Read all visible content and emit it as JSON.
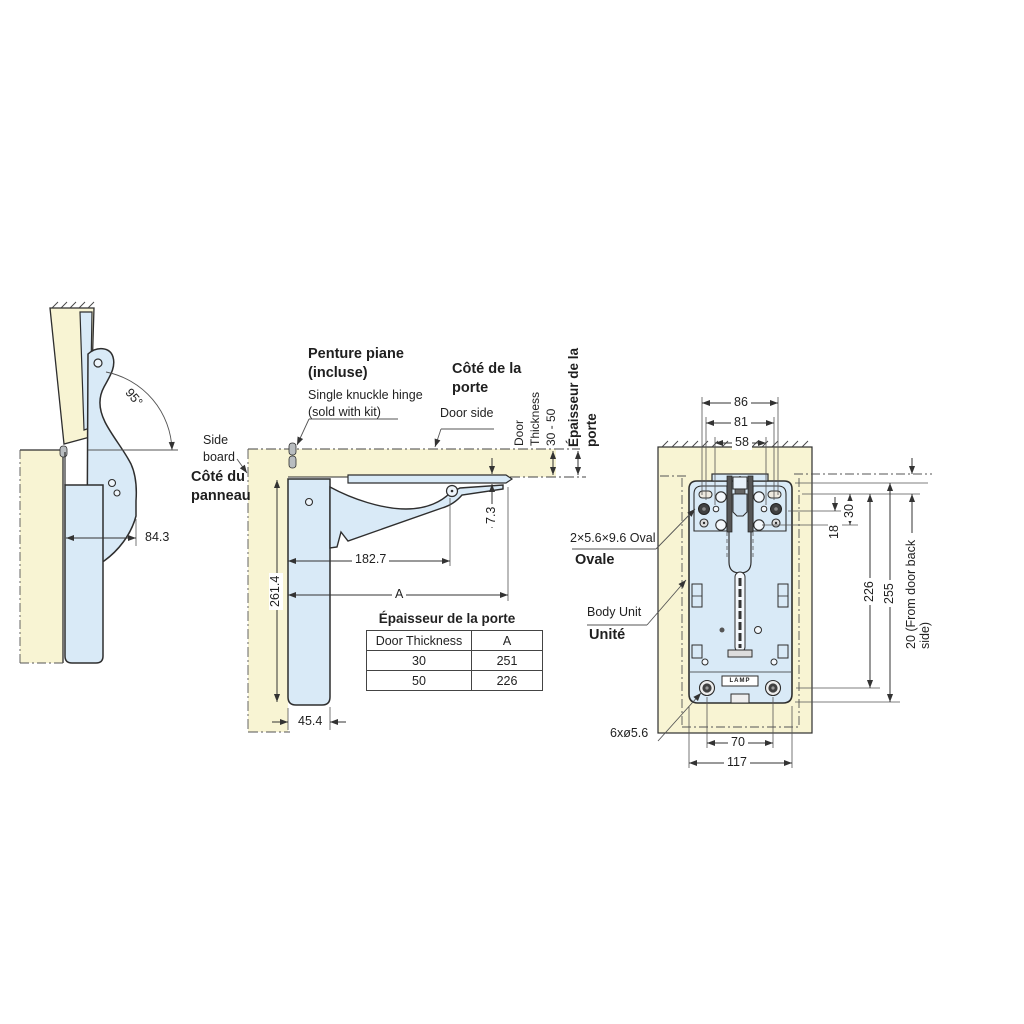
{
  "colors": {
    "wood": "#f8f4d3",
    "hardware": "#d9eaf7",
    "line": "#2e2e2e"
  },
  "left_view": {
    "angle": "95°",
    "dim_overhang": "84.3"
  },
  "middle_view": {
    "penture_title": "Penture piane\n(incluse)",
    "penture_sub": "Single knuckle hinge\n(sold with kit)",
    "side_board": "Side\nboard",
    "cote_panneau": "Côté du\npanneau",
    "cote_porte": "Côté de la\nporte",
    "door_side": "Door side",
    "door_thickness_rot": "Door\nThickness\n30 - 50",
    "epaisseur_rot": "Épaisseur de la\nporte",
    "dim_plate": "7.3",
    "dim_arm": "182.7",
    "dim_height": "261.4",
    "dim_a": "A",
    "dim_board_width": "45.4",
    "table": {
      "title": "Épaisseur de la porte",
      "headers": [
        "Door Thickness",
        "A"
      ],
      "rows": [
        [
          "30",
          "251"
        ],
        [
          "50",
          "226"
        ]
      ]
    }
  },
  "right_view": {
    "dim_86": "86",
    "dim_81": "81",
    "dim_58": "58",
    "dim_30": "30",
    "dim_18": "18",
    "dim_226": "226",
    "dim_255": "255",
    "dim_70": "70",
    "dim_117": "117",
    "dim_back": "20 (From door back side)",
    "oval_label": "2×5.6×9.6 Oval",
    "oval_fr": "Ovale",
    "body_label": "Body Unit",
    "body_fr": "Unité",
    "holes_label": "6xø5.6",
    "logo": "LAMP"
  }
}
